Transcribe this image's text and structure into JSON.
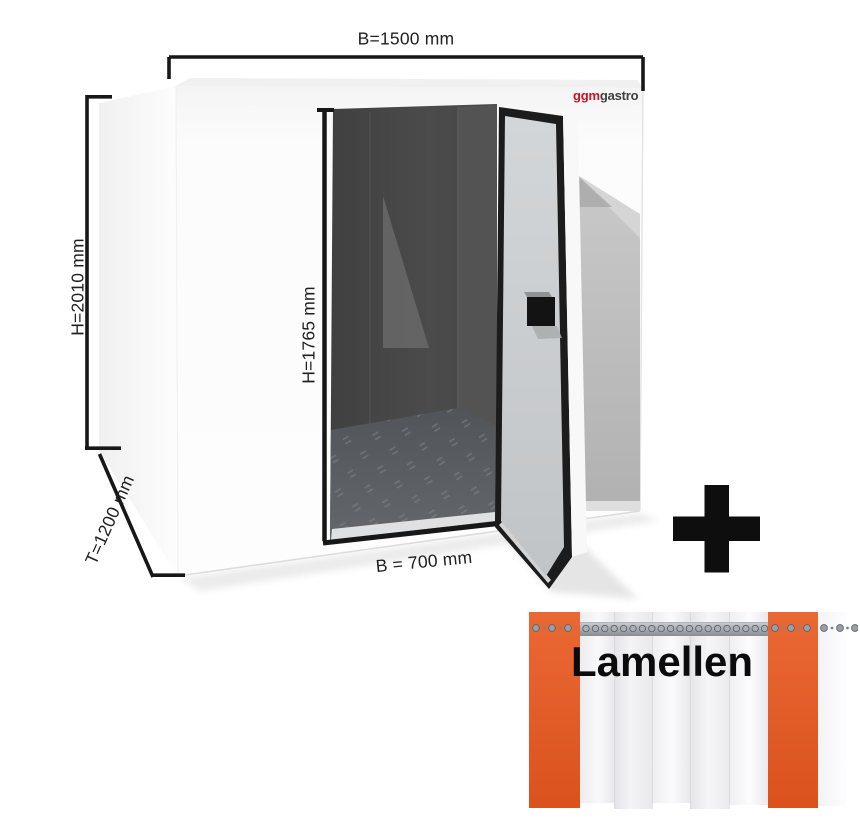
{
  "scene": {
    "logo": {
      "ggm": "ggm",
      "gastro": "gastro"
    },
    "dimensions": {
      "width_total": "B=1500 mm",
      "height_total": "H=2010 mm",
      "door_height": "H=1765 mm",
      "depth_total": "T=1200 mm",
      "door_width": "B = 700 mm"
    }
  },
  "addon": {
    "plus_icon": "plus-icon",
    "label": "Lamellen"
  },
  "colors": {
    "accent_orange": "#e8571e",
    "logo_red": "#c41425",
    "logo_dark": "#3f3f3f",
    "dimension_text": "#1f1f1f",
    "frame_black": "#171717"
  }
}
